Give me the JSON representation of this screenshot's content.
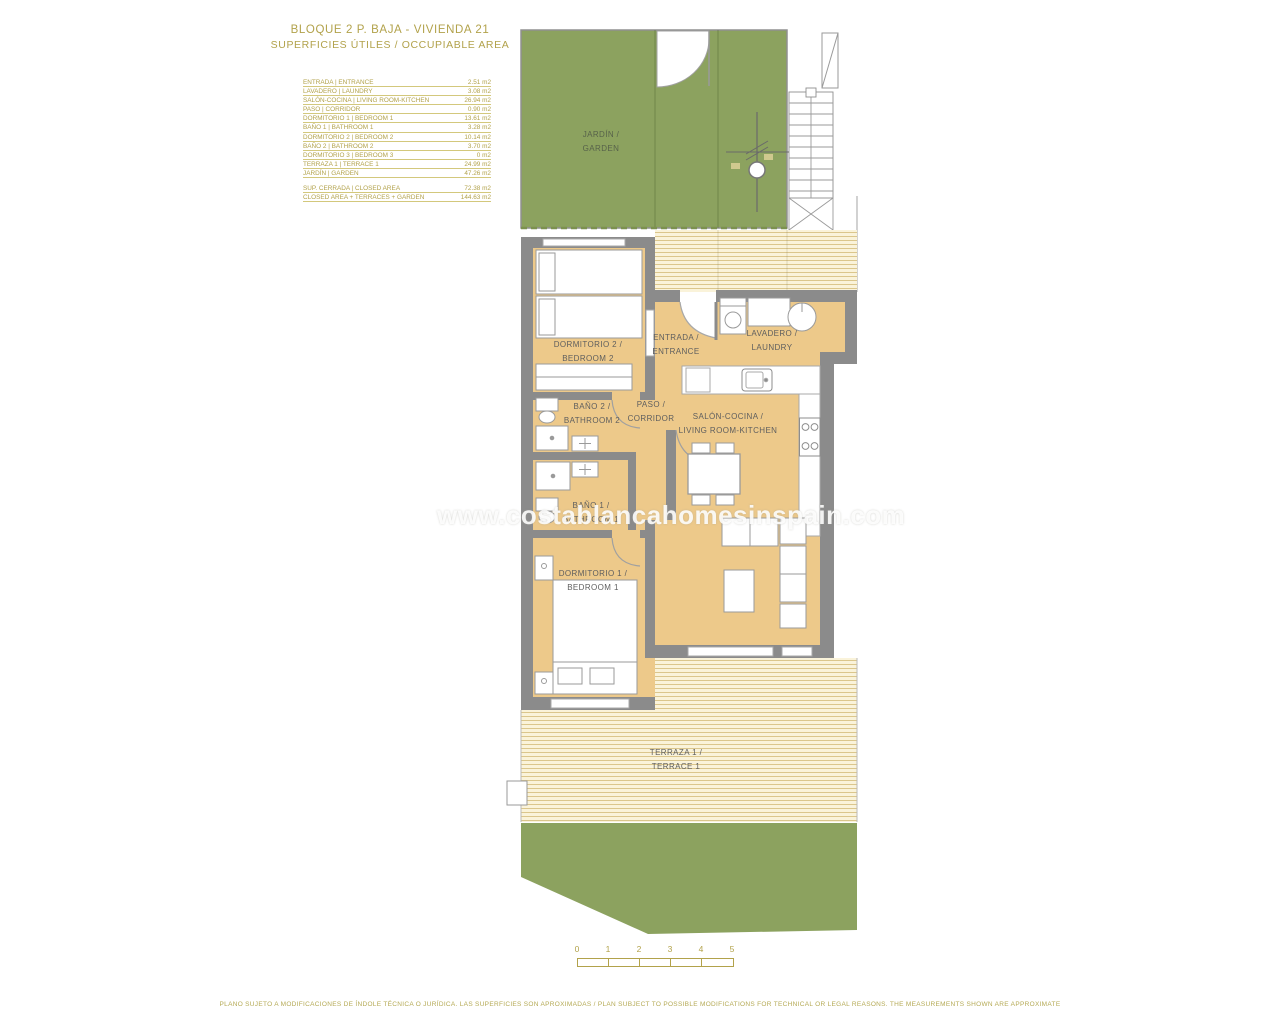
{
  "title": {
    "line1": "BLOQUE 2 P. BAJA - VIVIENDA 21",
    "line2": "SUPERFICIES ÚTILES / OCCUPIABLE AREA"
  },
  "legend": {
    "rows": [
      {
        "label": "ENTRADA | ENTRANCE",
        "value": "2.51 m2"
      },
      {
        "label": "LAVADERO | LAUNDRY",
        "value": "3.08 m2"
      },
      {
        "label": "SALÓN-COCINA | LIVING ROOM-KITCHEN",
        "value": "26.94 m2"
      },
      {
        "label": "PASO | CORRIDOR",
        "value": "0.90 m2"
      },
      {
        "label": "DORMITORIO 1 | BEDROOM 1",
        "value": "13.61 m2"
      },
      {
        "label": "BAÑO 1 | BATHROOM 1",
        "value": "3.28 m2"
      },
      {
        "label": "DORMITORIO 2 | BEDROOM 2",
        "value": "10.14 m2"
      },
      {
        "label": "BAÑO 2 | BATHROOM 2",
        "value": "3.70 m2"
      },
      {
        "label": "DORMITORIO 3 | BEDROOM 3",
        "value": "0 m2"
      },
      {
        "label": "TERRAZA 1 | TERRACE 1",
        "value": "24.99 m2"
      },
      {
        "label": "JARDÍN | GARDEN",
        "value": "47.26 m2"
      }
    ],
    "totals": [
      {
        "label": "SUP. CERRADA | CLOSED AREA",
        "value": "72.38 m2"
      },
      {
        "label": "CLOSED AREA + TERRACES + GARDEN",
        "value": "144.63 m2"
      }
    ]
  },
  "plan": {
    "rooms": {
      "garden": {
        "line1": "JARDÍN /",
        "line2": "GARDEN"
      },
      "bedroom2": {
        "line1": "DORMITORIO 2 /",
        "line2": "BEDROOM 2"
      },
      "entrance": {
        "line1": "ENTRADA /",
        "line2": "ENTRANCE"
      },
      "laundry": {
        "line1": "LAVADERO /",
        "line2": "LAUNDRY"
      },
      "bathroom2": {
        "line1": "BAÑO 2 /",
        "line2": "BATHROOM 2"
      },
      "corridor": {
        "line1": "PASO /",
        "line2": "CORRIDOR"
      },
      "living": {
        "line1": "SALÓN-COCINA /",
        "line2": "LIVING ROOM-KITCHEN"
      },
      "bathroom1": {
        "line1": "BAÑO 1 /",
        "line2": "BATHROOM 1"
      },
      "bedroom1": {
        "line1": "DORMITORIO 1 /",
        "line2": "BEDROOM 1"
      },
      "terrace1": {
        "line1": "TERRAZA 1 /",
        "line2": "TERRACE 1"
      }
    }
  },
  "watermark": "www.costablancahomesinspain.com",
  "scale_bar": {
    "ticks": [
      "0",
      "1",
      "2",
      "3",
      "4",
      "5"
    ]
  },
  "disclaimer": "PLANO SUJETO A MODIFICACIONES DE ÍNDOLE TÉCNICA O JURÍDICA. LAS SUPERFICIES SON APROXIMADAS / PLAN SUBJECT TO POSSIBLE MODIFICATIONS FOR TECHNICAL OR LEGAL REASONS. THE MEASUREMENTS SHOWN ARE APPROXIMATE",
  "colors": {
    "accent_olive": "#b2a24b",
    "room_beige": "#edc98a",
    "wall_gray": "#8b8b8b",
    "garden_green": "#8ca25f",
    "deck_stripe": "#dbc68c",
    "label_gray": "#5e5e5e"
  }
}
